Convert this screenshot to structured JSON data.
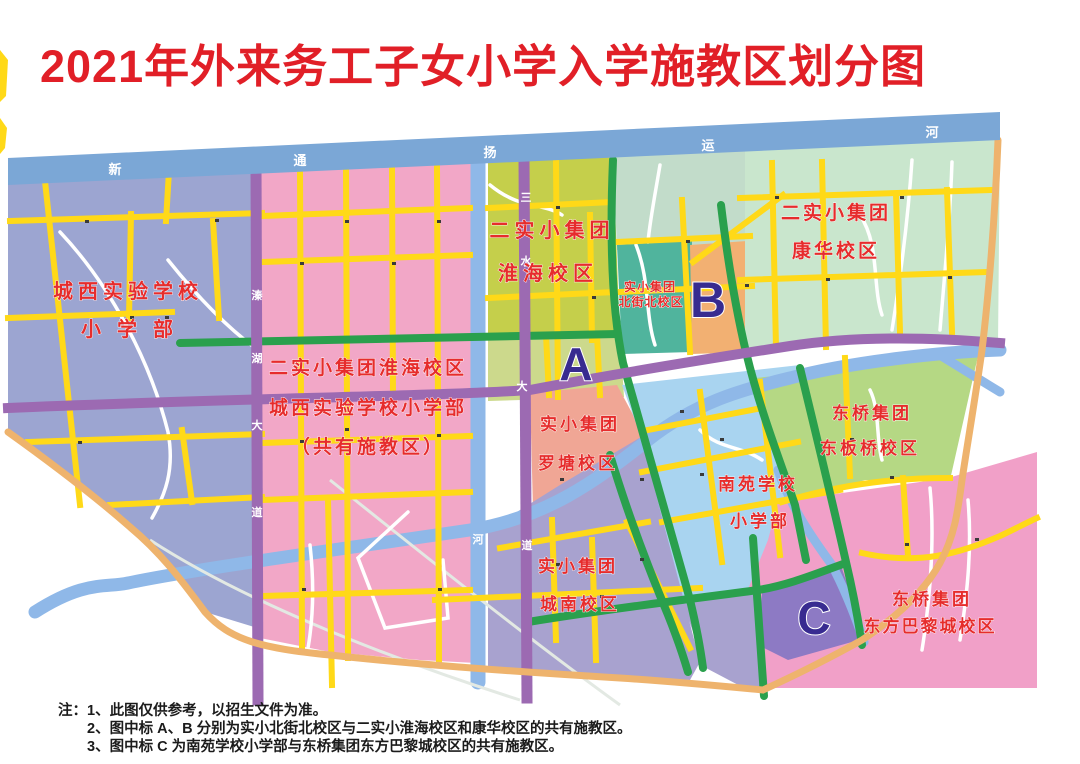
{
  "title": "2021年外来务工子女小学入学施教区划分图",
  "colors": {
    "title_red": "#e11f27",
    "label_red": "#e62c2c",
    "marker_indigo": "#382b90",
    "road_yellow": "#ffd918",
    "road_green": "#2aa04d",
    "road_purple": "#9c6ab2",
    "boundary_tan": "#eeb36d",
    "river_blue": "#8fb8e8",
    "canal_blue": "#7ba7d6"
  },
  "map": {
    "rivers": {
      "canal": {
        "name": "新通扬运河",
        "chars": [
          "新",
          "通",
          "扬",
          "运",
          "河"
        ]
      },
      "vertical": {
        "char": "河"
      }
    },
    "roads": {
      "qinhu": {
        "name": "溱湖大道",
        "chars": [
          "溱",
          "湖",
          "大",
          "道"
        ]
      },
      "sanshui": {
        "name": "三水大道",
        "chars": [
          "三",
          "水",
          "大",
          "道"
        ]
      }
    },
    "regions": [
      {
        "key": "chengxi",
        "lines": [
          "城西实验学校",
          "小学部"
        ]
      },
      {
        "key": "huaihai-shared",
        "lines": [
          "二实小集团淮海校区",
          "城西实验学校小学部",
          "（共有施教区）"
        ]
      },
      {
        "key": "huaihai",
        "lines": [
          "二实小集团",
          "淮海校区"
        ]
      },
      {
        "key": "beijiebei",
        "lines": [
          "实小集团",
          "北街北校区"
        ]
      },
      {
        "key": "kanghua",
        "lines": [
          "二实小集团",
          "康华校区"
        ]
      },
      {
        "key": "luotang",
        "lines": [
          "实小集团",
          "罗塘校区"
        ]
      },
      {
        "key": "dongbanqiao",
        "lines": [
          "东桥集团",
          "东板桥校区"
        ]
      },
      {
        "key": "nanyuan",
        "lines": [
          "南苑学校",
          "小学部"
        ]
      },
      {
        "key": "chengnan",
        "lines": [
          "实小集团",
          "城南校区"
        ]
      },
      {
        "key": "dongfangbali",
        "lines": [
          "东桥集团",
          "东方巴黎城校区"
        ]
      }
    ],
    "markers": [
      {
        "label": "A"
      },
      {
        "label": "B"
      },
      {
        "label": "C"
      }
    ]
  },
  "notes": {
    "label": "注：",
    "items": [
      "1、此图仅供参考，以招生文件为准。",
      "2、图中标 A、B 分别为实小北街北校区与二实小淮海校区和康华校区的共有施教区。",
      "3、图中标 C 为南苑学校小学部与东桥集团东方巴黎城校区的共有施教区。"
    ]
  }
}
